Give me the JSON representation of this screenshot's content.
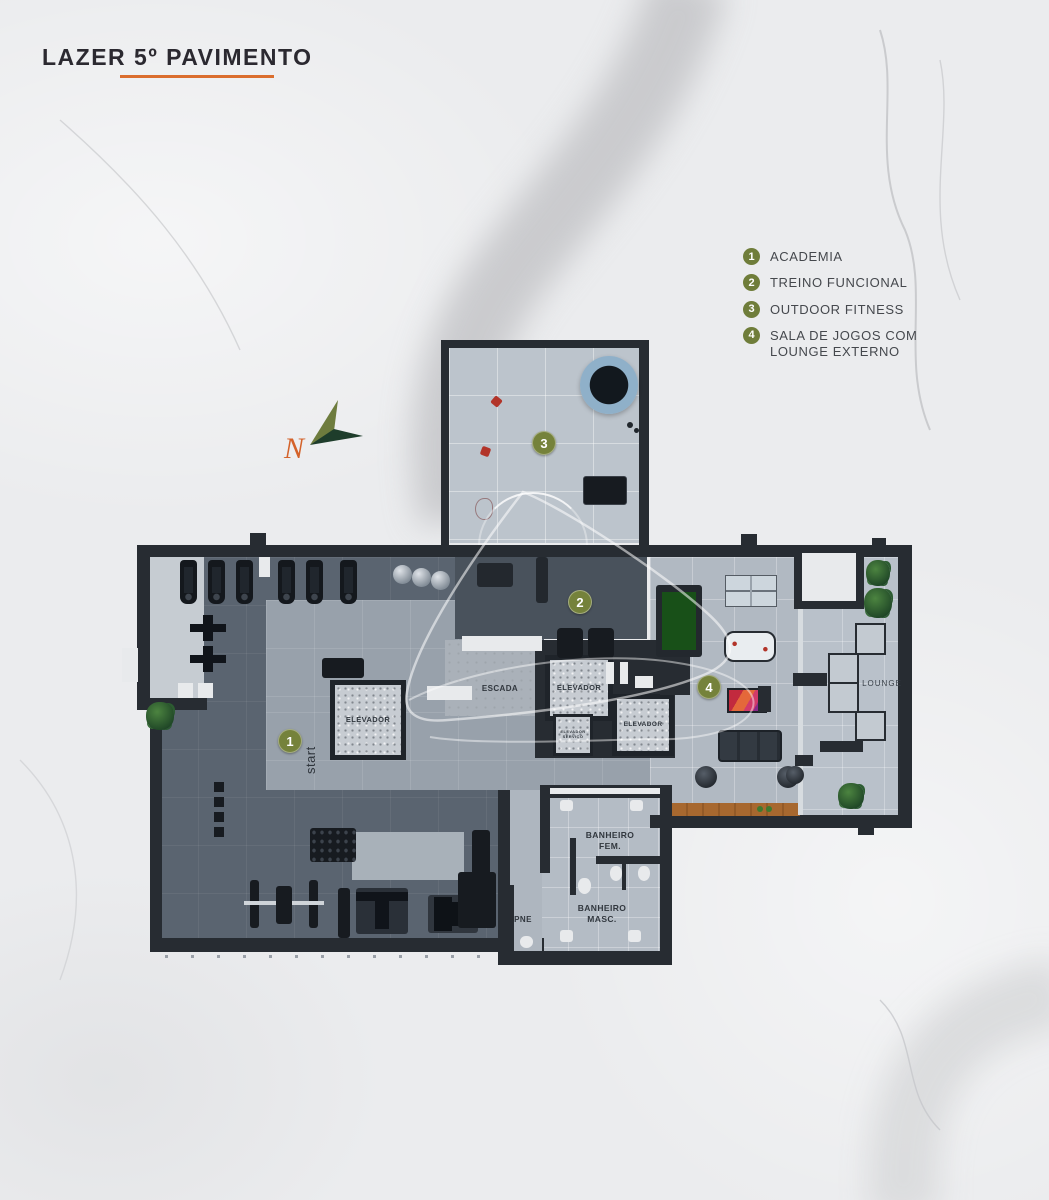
{
  "title": {
    "text": "LAZER 5º PAVIMENTO"
  },
  "legend": {
    "items": [
      {
        "number": "1",
        "label": "ACADEMIA"
      },
      {
        "number": "2",
        "label": "TREINO FUNCIONAL"
      },
      {
        "number": "3",
        "label": "OUTDOOR FITNESS"
      },
      {
        "number": "4",
        "label": "SALA DE JOGOS COM LOUNGE EXTERNO"
      }
    ]
  },
  "compass": {
    "north_label": "N"
  },
  "plan": {
    "markers": [
      {
        "number": "1"
      },
      {
        "number": "2"
      },
      {
        "number": "3"
      },
      {
        "number": "4"
      }
    ],
    "labels": {
      "elevator_1": "ELEVADOR",
      "elevator_2": "ELEVADOR",
      "elevator_3": "ELEVADOR",
      "service_elevator": "ELEVADOR SERVIÇO",
      "stairs": "ESCADA",
      "bathroom_female": "BANHEIRO FEM.",
      "bathroom_male": "BANHEIRO MASC.",
      "accessible_bathroom": "PNE",
      "lounge": "LOUNGE",
      "start": "start"
    }
  },
  "colors": {
    "accent_orange": "#DB6E2E",
    "marker_olive": "#75823B",
    "wall_dark": "#272C32",
    "snooker_green": "#185018",
    "wood_deck": "#A7682F",
    "pool_ring_blue": "#8FB0C9"
  }
}
